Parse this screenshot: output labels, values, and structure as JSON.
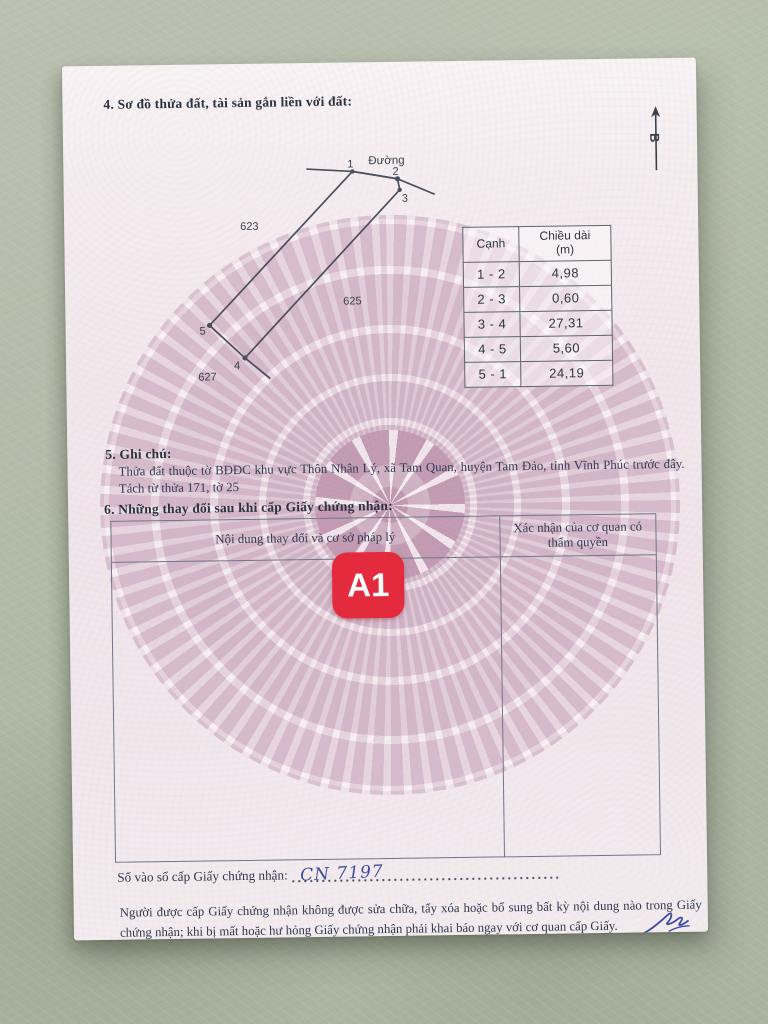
{
  "document": {
    "section4": {
      "heading": "4. Sơ đồ thửa đất, tài sản gắn liền với đất:"
    },
    "compass": {
      "north_label": "B"
    },
    "diagram": {
      "road_label": "Đường",
      "adjacent_parcels": {
        "left": "623",
        "middle": "625",
        "bottom": "627"
      },
      "point_labels": {
        "p1": "1",
        "p2": "2",
        "p3": "3",
        "p4": "4",
        "p5": "5"
      }
    },
    "edge_table": {
      "col_edge": "Cạnh",
      "col_length_line1": "Chiều dài",
      "col_length_line2": "(m)",
      "rows": [
        {
          "edge": "1 - 2",
          "length": "4,98"
        },
        {
          "edge": "2 - 3",
          "length": "0,60"
        },
        {
          "edge": "3 - 4",
          "length": "27,31"
        },
        {
          "edge": "4 - 5",
          "length": "5,60"
        },
        {
          "edge": "5 - 1",
          "length": "24,19"
        }
      ]
    },
    "section5": {
      "heading": "5. Ghi chú:",
      "body": "Thửa đất thuộc tờ BĐĐC khu vực Thôn Nhân Lý, xã Tam Quan, huyện Tam Đảo, tỉnh Vĩnh Phúc trước đây. Tách từ thửa 171, tờ 25"
    },
    "section6": {
      "heading": "6. Những thay đổi sau khi cấp Giấy chứng nhận:",
      "col1_header": "Nội dung thay đổi và cơ sở pháp lý",
      "col2_header": "Xác nhận của cơ quan có thẩm quyền"
    },
    "page_stamp": "A1",
    "register_line": {
      "label": "Số vào sổ cấp Giấy chứng nhận:",
      "value": "CN 7197"
    },
    "footer": "Người được cấp Giấy chứng nhận không được sửa chữa, tẩy xóa hoặc bổ sung bất kỳ nội dung nào trong Giấy chứng nhận; khi bị mất hoặc hư hỏng Giấy chứng nhận phải khai báo ngay với cơ quan cấp Giấy."
  },
  "colors": {
    "stamp_red": "#e42b3d",
    "handwriting_blue": "#3d4da0"
  }
}
